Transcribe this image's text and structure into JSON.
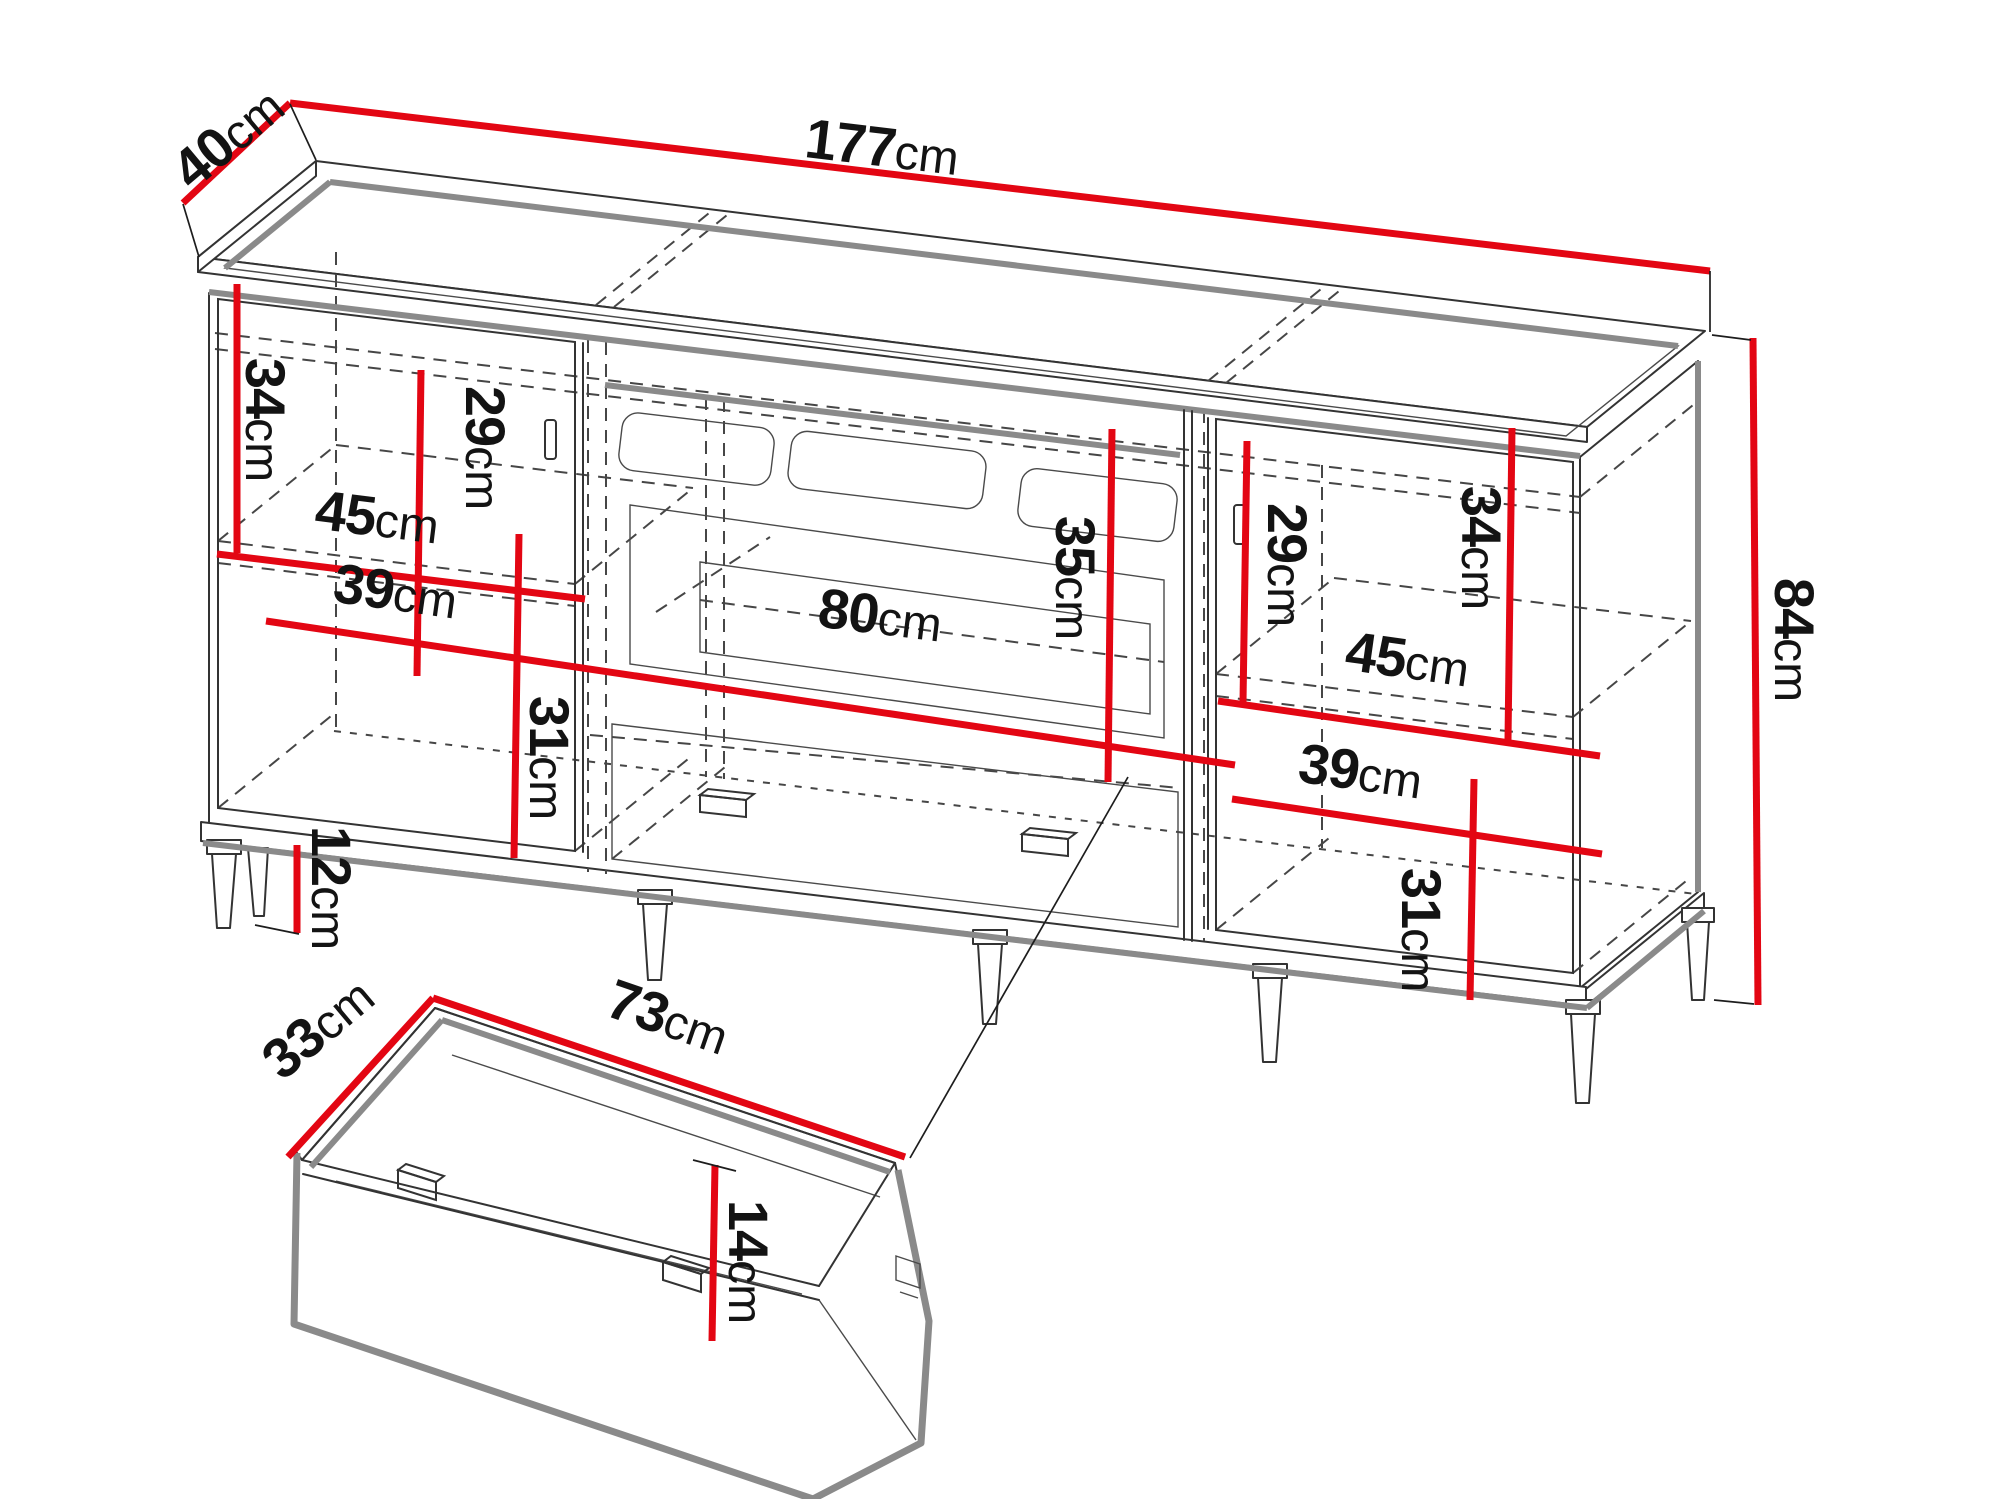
{
  "colors": {
    "dimension_red": "#e30613",
    "outline": "#333333",
    "shade": "#8a8a8a"
  },
  "cabinet": {
    "width": {
      "value": "177",
      "unit": "cm"
    },
    "depth": {
      "value": "40",
      "unit": "cm"
    },
    "height": {
      "value": "84",
      "unit": "cm"
    },
    "leg_height": {
      "value": "12",
      "unit": "cm"
    },
    "left": {
      "upper_inner_height": {
        "value": "34",
        "unit": "cm"
      },
      "door_inner_height": {
        "value": "29",
        "unit": "cm"
      },
      "shelf_width_upper": {
        "value": "45",
        "unit": "cm"
      },
      "shelf_width_lower": {
        "value": "39",
        "unit": "cm"
      },
      "lower_inner_height": {
        "value": "31",
        "unit": "cm"
      }
    },
    "center": {
      "fireplace_width": {
        "value": "80",
        "unit": "cm"
      },
      "fireplace_height": {
        "value": "35",
        "unit": "cm"
      }
    },
    "right": {
      "door_inner_height": {
        "value": "29",
        "unit": "cm"
      },
      "upper_inner_height": {
        "value": "34",
        "unit": "cm"
      },
      "shelf_width_upper": {
        "value": "45",
        "unit": "cm"
      },
      "shelf_width_lower": {
        "value": "39",
        "unit": "cm"
      },
      "lower_inner_height": {
        "value": "31",
        "unit": "cm"
      }
    }
  },
  "drawer": {
    "width": {
      "value": "73",
      "unit": "cm"
    },
    "depth": {
      "value": "33",
      "unit": "cm"
    },
    "height": {
      "value": "14",
      "unit": "cm"
    }
  }
}
